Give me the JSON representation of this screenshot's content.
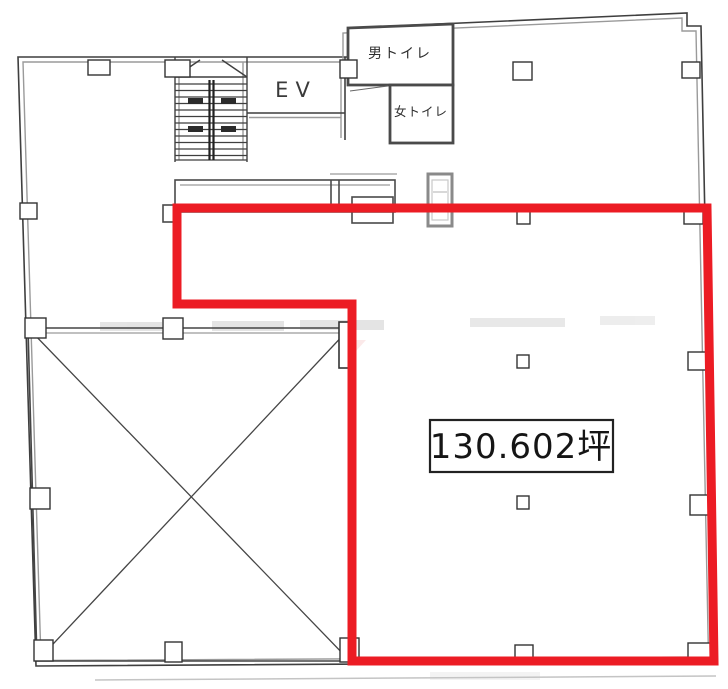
{
  "plan": {
    "labels": {
      "elevator": "EV",
      "mens_toilet": "男トイレ",
      "womens_toilet": "女トイレ",
      "area": "130.602坪"
    },
    "colors": {
      "highlight_red": "#EC1C24",
      "wall_dark": "#3f3f3f",
      "wall_light": "#9a9a9a"
    }
  }
}
